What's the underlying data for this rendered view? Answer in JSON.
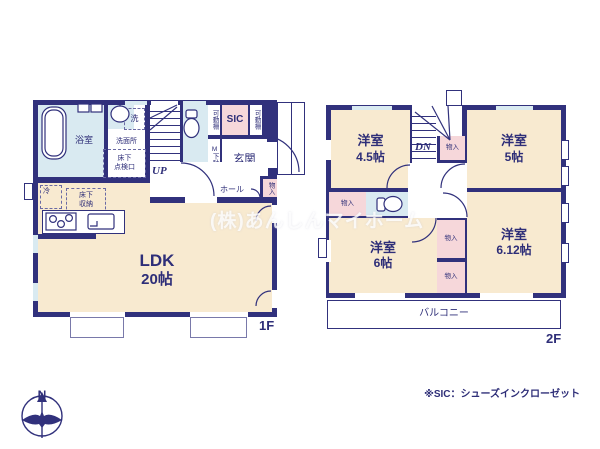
{
  "page": {
    "watermark": "(株)あんしんマイホーム",
    "footnote": "※SIC：シューズインクローゼット",
    "floor1_label": "1F",
    "floor2_label": "2F",
    "compass": {
      "north": "N"
    }
  },
  "floor1": {
    "ldk": {
      "name": "LDK",
      "size": "20帖"
    },
    "bath": "浴室",
    "laundry": "洗",
    "washroom": "洗面所",
    "underfloor_hatch": "床下\n点検口",
    "fridge": "冷",
    "underfloor_storage": "床下\n収納",
    "stairs": "UP",
    "shelf": "可動棚",
    "sic": "SIC",
    "shoe_cabinet": "M下駄箱",
    "entrance": "玄関",
    "hall": "ホール",
    "closet": "物入"
  },
  "floor2": {
    "rooms": [
      {
        "name": "洋室",
        "size": "4.5帖"
      },
      {
        "name": "洋室",
        "size": "5帖"
      },
      {
        "name": "洋室",
        "size": "6帖"
      },
      {
        "name": "洋室",
        "size": "6.12帖"
      }
    ],
    "stairs": "DN",
    "closet": "物入",
    "balcony": "バルコニー"
  },
  "colors": {
    "wall": "#31317c",
    "room_fill": "#f8ead0",
    "closet_fill": "#f6d7da",
    "wet_fill": "#d9eaf1",
    "text": "#2e2e78",
    "watermark": "rgba(255,255,255,0.8)"
  }
}
